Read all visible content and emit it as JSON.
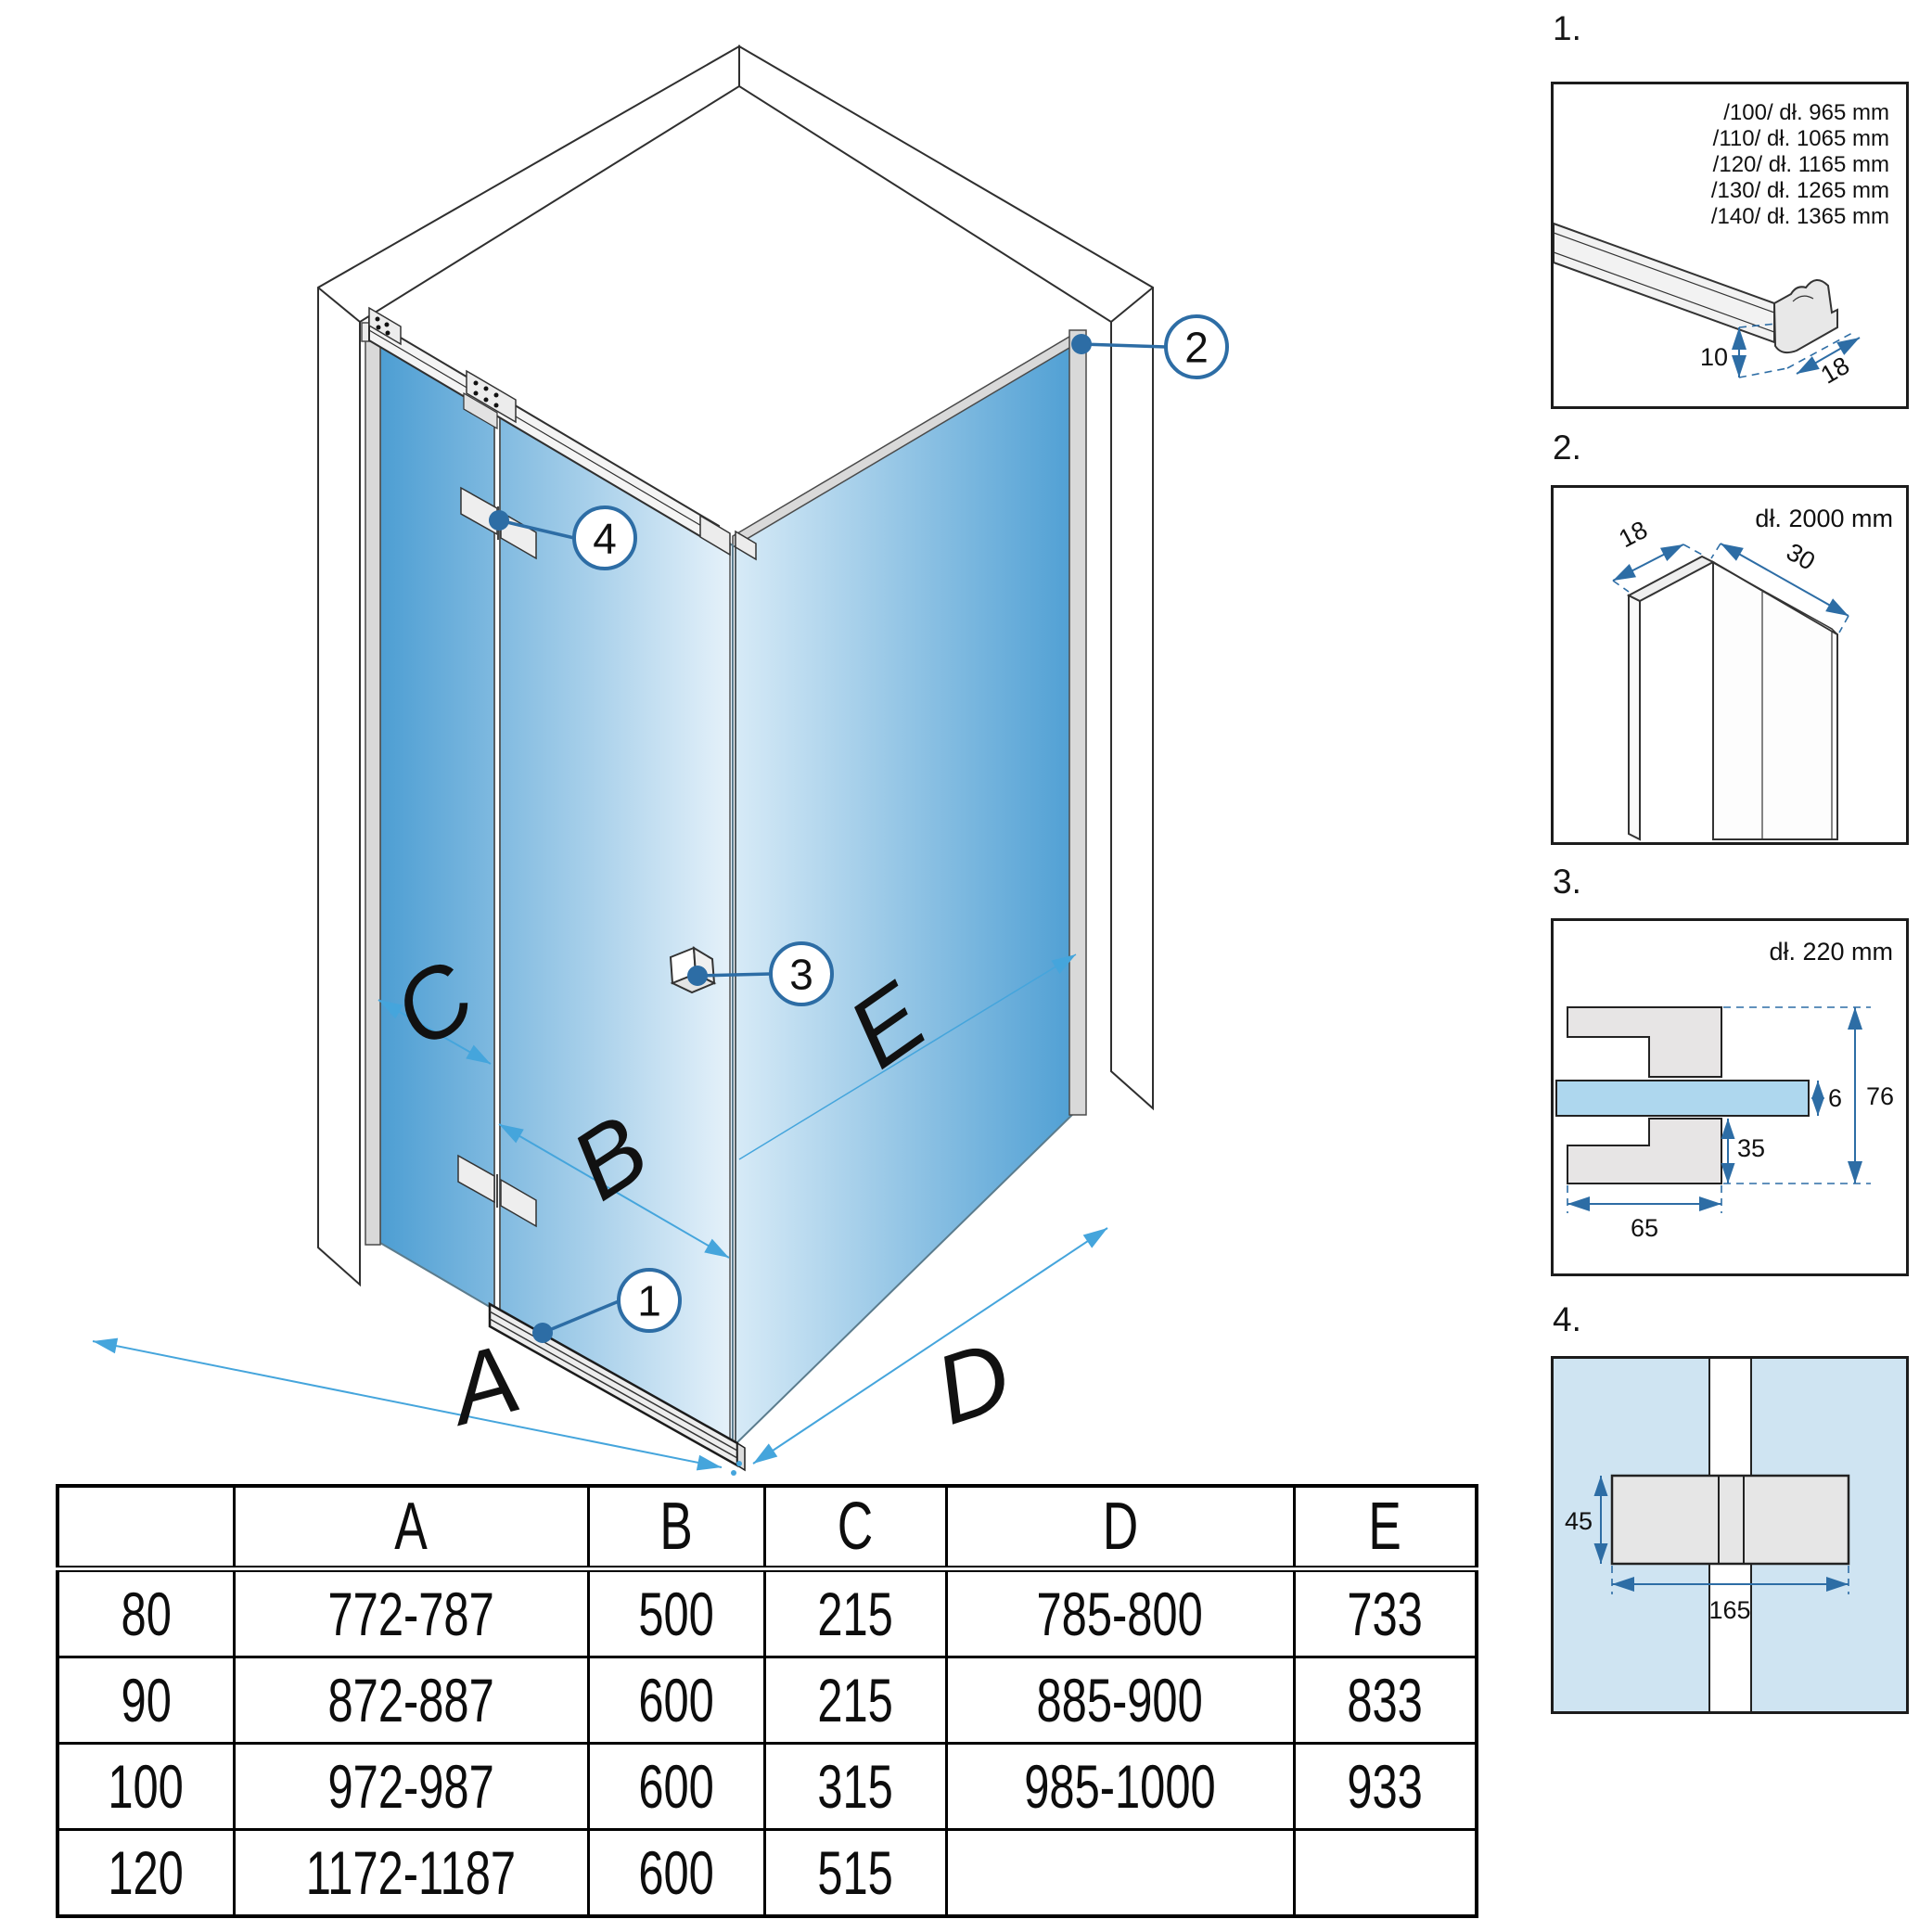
{
  "colors": {
    "callout_blue": "#2d6da5",
    "dimension_arrow_blue": "#45a5dc",
    "glass_deep": "#4d9ed3",
    "glass_pale": "#eaf4fb",
    "profile_gray": "#d9d9d9",
    "detail_glass_blue": "#aed7ee",
    "detail_panel_blue": "#cfe4f2"
  },
  "main_diagram": {
    "dimension_letters": [
      "A",
      "B",
      "C",
      "D",
      "E"
    ],
    "callouts": [
      "1",
      "2",
      "3",
      "4"
    ]
  },
  "details": [
    {
      "label": "1.",
      "size_lines": [
        "/100/ dł. 965 mm",
        "/110/ dł. 1065 mm",
        "/120/ dł. 1165 mm",
        "/130/ dł. 1265 mm",
        "/140/ dł. 1365 mm"
      ],
      "dims": {
        "height": "10",
        "depth": "18"
      }
    },
    {
      "label": "2.",
      "length": "dł. 2000 mm",
      "dims": {
        "thickness": "18",
        "depth": "30"
      }
    },
    {
      "label": "3.",
      "length": "dł. 220 mm",
      "dims": {
        "glass_thickness": "6",
        "total_height": "76",
        "lower_height": "35",
        "width": "65"
      }
    },
    {
      "label": "4.",
      "dims": {
        "height": "45",
        "width": "165"
      }
    }
  ],
  "table": {
    "headers": [
      "",
      "A",
      "B",
      "C",
      "D",
      "E"
    ],
    "rows": [
      [
        "80",
        "772-787",
        "500",
        "215",
        "785-800",
        "733"
      ],
      [
        "90",
        "872-887",
        "600",
        "215",
        "885-900",
        "833"
      ],
      [
        "100",
        "972-987",
        "600",
        "315",
        "985-1000",
        "933"
      ],
      [
        "120",
        "1172-1187",
        "600",
        "515",
        "",
        ""
      ]
    ]
  }
}
